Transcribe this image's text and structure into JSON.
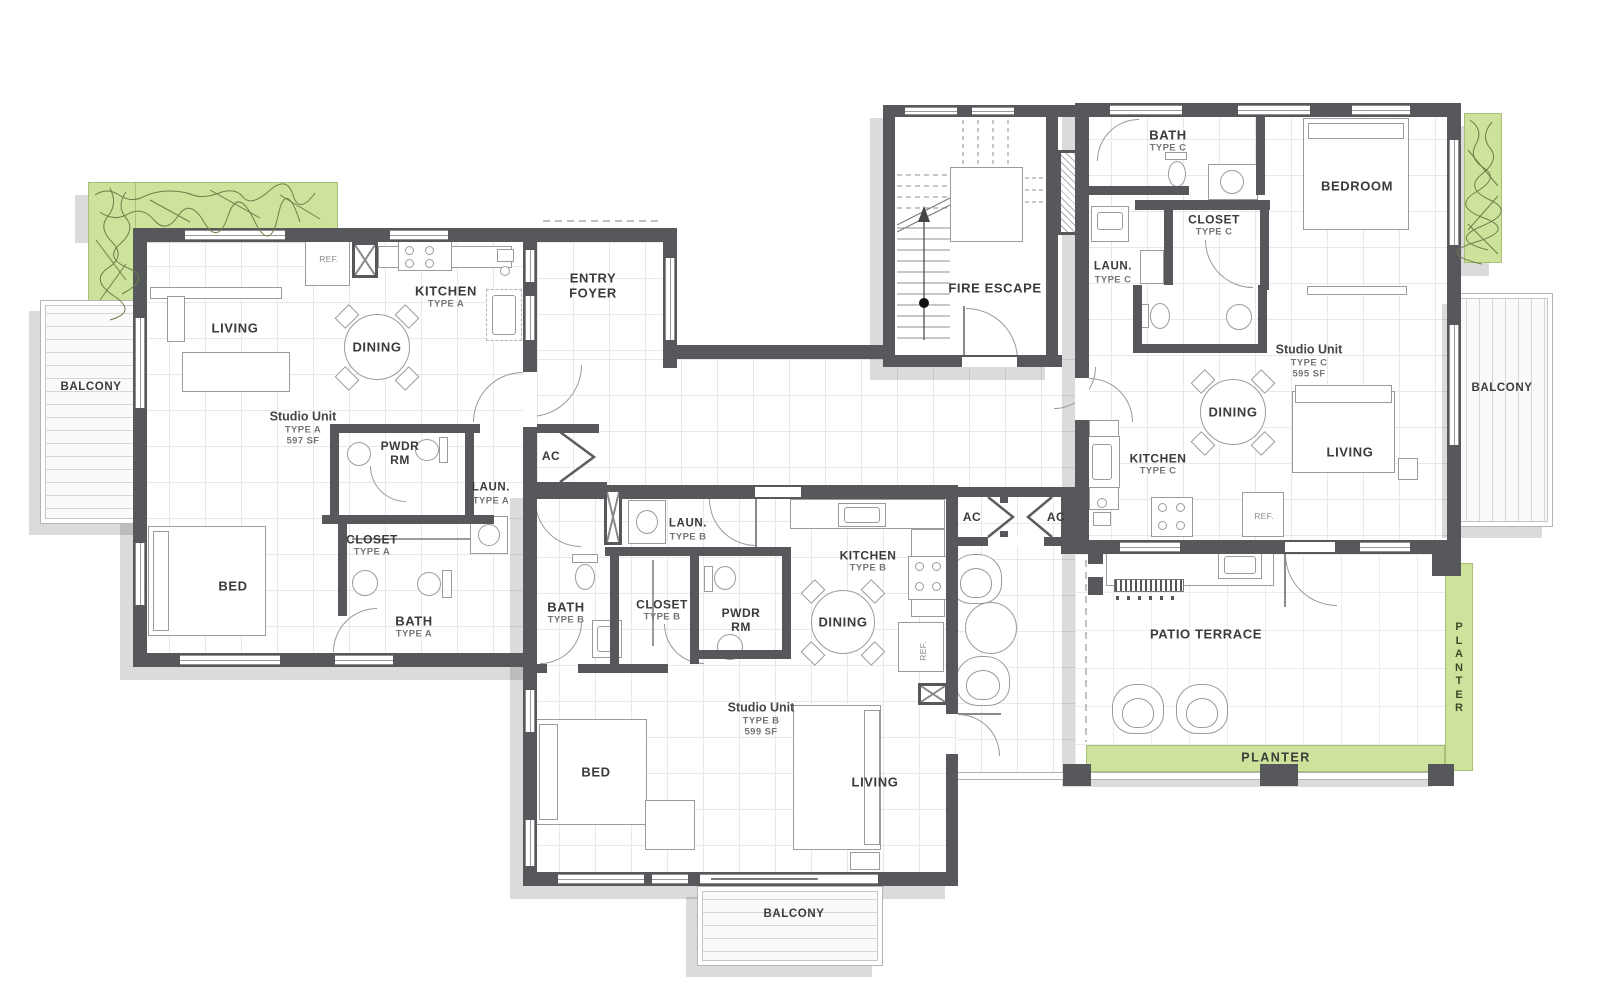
{
  "drawing": {
    "kind": "residential floor plan",
    "units": [
      {
        "name": "Studio Unit",
        "type": "TYPE A",
        "area": "597 SF"
      },
      {
        "name": "Studio Unit",
        "type": "TYPE B",
        "area": "599 SF"
      },
      {
        "name": "Studio Unit",
        "type": "TYPE C",
        "area": "595 SF"
      }
    ]
  },
  "colors": {
    "wall": "#57585c",
    "planter_green": "#cde39c",
    "shadow": "rgba(0,0,0,0.14)",
    "text_main": "#3b3b3b",
    "text_sub": "#747474"
  },
  "labels": [
    {
      "name": "room-label-living-a",
      "x": 235,
      "y": 328,
      "lines": [
        {
          "t": "LIVING",
          "s": "main"
        }
      ]
    },
    {
      "name": "room-label-dining-a",
      "x": 377,
      "y": 347,
      "lines": [
        {
          "t": "DINING",
          "s": "main"
        }
      ]
    },
    {
      "name": "room-label-kitchen-a",
      "x": 446,
      "y": 297,
      "lines": [
        {
          "t": "KITCHEN",
          "s": "main"
        },
        {
          "t": "TYPE A",
          "s": "sub"
        }
      ]
    },
    {
      "name": "label-ref-a",
      "x": 329,
      "y": 259,
      "lines": [
        {
          "t": "REF.",
          "s": "tiny"
        }
      ]
    },
    {
      "name": "unit-label-studio-a",
      "x": 303,
      "y": 428,
      "lines": [
        {
          "t": "Studio Unit",
          "s": "studio"
        },
        {
          "t": "TYPE A",
          "s": "sub"
        },
        {
          "t": "597 SF",
          "s": "sub"
        }
      ]
    },
    {
      "name": "room-label-pwdr-a",
      "x": 400,
      "y": 453,
      "lines": [
        {
          "t": "PWDR",
          "s": "main12"
        },
        {
          "t": "RM",
          "s": "main12"
        }
      ]
    },
    {
      "name": "label-ac-a",
      "x": 551,
      "y": 456,
      "lines": [
        {
          "t": "AC",
          "s": "main12"
        }
      ]
    },
    {
      "name": "room-label-laun-a",
      "x": 491,
      "y": 494,
      "lines": [
        {
          "t": "LAUN.",
          "s": "main11"
        },
        {
          "t": "TYPE A",
          "s": "sub"
        }
      ]
    },
    {
      "name": "room-label-closet-a",
      "x": 372,
      "y": 545,
      "lines": [
        {
          "t": "CLOSET",
          "s": "main12"
        },
        {
          "t": "TYPE A",
          "s": "sub"
        }
      ]
    },
    {
      "name": "room-label-bed-a",
      "x": 233,
      "y": 586,
      "lines": [
        {
          "t": "BED",
          "s": "main"
        }
      ]
    },
    {
      "name": "room-label-bath-a",
      "x": 414,
      "y": 627,
      "lines": [
        {
          "t": "BATH",
          "s": "main"
        },
        {
          "t": "TYPE A",
          "s": "sub"
        }
      ]
    },
    {
      "name": "room-label-entry-foyer",
      "x": 593,
      "y": 286,
      "lines": [
        {
          "t": "ENTRY",
          "s": "main"
        },
        {
          "t": "FOYER",
          "s": "main"
        }
      ]
    },
    {
      "name": "room-label-fire-escape",
      "x": 995,
      "y": 288,
      "lines": [
        {
          "t": "FIRE ESCAPE",
          "s": "main"
        }
      ]
    },
    {
      "name": "label-balcony-left",
      "x": 91,
      "y": 388,
      "lines": [
        {
          "t": "BALCONY",
          "s": "main11"
        }
      ]
    },
    {
      "name": "label-ac-mid-1",
      "x": 972,
      "y": 517,
      "lines": [
        {
          "t": "AC",
          "s": "main12"
        }
      ]
    },
    {
      "name": "label-ac-mid-2",
      "x": 1056,
      "y": 517,
      "lines": [
        {
          "t": "AC",
          "s": "main12"
        }
      ]
    },
    {
      "name": "room-label-bath-c",
      "x": 1168,
      "y": 141,
      "lines": [
        {
          "t": "BATH",
          "s": "main"
        },
        {
          "t": "TYPE C",
          "s": "sub"
        }
      ]
    },
    {
      "name": "room-label-bedroom-c",
      "x": 1357,
      "y": 186,
      "lines": [
        {
          "t": "BEDROOM",
          "s": "main"
        }
      ]
    },
    {
      "name": "room-label-closet-c",
      "x": 1214,
      "y": 225,
      "lines": [
        {
          "t": "CLOSET",
          "s": "main12"
        },
        {
          "t": "TYPE C",
          "s": "sub"
        }
      ]
    },
    {
      "name": "room-label-laun-c",
      "x": 1113,
      "y": 273,
      "lines": [
        {
          "t": "LAUN.",
          "s": "main11"
        },
        {
          "t": "TYPE C",
          "s": "sub"
        }
      ]
    },
    {
      "name": "unit-label-studio-c",
      "x": 1309,
      "y": 361,
      "lines": [
        {
          "t": "Studio Unit",
          "s": "studio"
        },
        {
          "t": "TYPE C",
          "s": "sub"
        },
        {
          "t": "595 SF",
          "s": "sub"
        }
      ]
    },
    {
      "name": "room-label-dining-c",
      "x": 1233,
      "y": 412,
      "lines": [
        {
          "t": "DINING",
          "s": "main"
        }
      ]
    },
    {
      "name": "room-label-kitchen-c",
      "x": 1158,
      "y": 464,
      "lines": [
        {
          "t": "KITCHEN",
          "s": "main12"
        },
        {
          "t": "TYPE C",
          "s": "sub"
        }
      ]
    },
    {
      "name": "room-label-living-c",
      "x": 1350,
      "y": 452,
      "lines": [
        {
          "t": "LIVING",
          "s": "main"
        }
      ]
    },
    {
      "name": "label-ref-c",
      "x": 1264,
      "y": 516,
      "lines": [
        {
          "t": "REF.",
          "s": "tiny"
        }
      ]
    },
    {
      "name": "label-balcony-right",
      "x": 1502,
      "y": 389,
      "lines": [
        {
          "t": "BALCONY",
          "s": "main11"
        }
      ]
    },
    {
      "name": "room-label-laun-b",
      "x": 688,
      "y": 530,
      "lines": [
        {
          "t": "LAUN.",
          "s": "main11"
        },
        {
          "t": "TYPE B",
          "s": "sub"
        }
      ]
    },
    {
      "name": "room-label-bath-b",
      "x": 566,
      "y": 613,
      "lines": [
        {
          "t": "BATH",
          "s": "main"
        },
        {
          "t": "TYPE B",
          "s": "sub"
        }
      ]
    },
    {
      "name": "room-label-closet-b",
      "x": 662,
      "y": 610,
      "lines": [
        {
          "t": "CLOSET",
          "s": "main12"
        },
        {
          "t": "TYPE B",
          "s": "sub"
        }
      ]
    },
    {
      "name": "room-label-pwdr-b",
      "x": 741,
      "y": 620,
      "lines": [
        {
          "t": "PWDR",
          "s": "main12"
        },
        {
          "t": "RM",
          "s": "main12"
        }
      ]
    },
    {
      "name": "room-label-kitchen-b",
      "x": 868,
      "y": 561,
      "lines": [
        {
          "t": "KITCHEN",
          "s": "main12"
        },
        {
          "t": "TYPE B",
          "s": "sub"
        }
      ]
    },
    {
      "name": "room-label-dining-b",
      "x": 843,
      "y": 622,
      "lines": [
        {
          "t": "DINING",
          "s": "main"
        }
      ]
    },
    {
      "name": "label-ref-b",
      "x": 923,
      "y": 651,
      "rot": -90,
      "lines": [
        {
          "t": "REF.",
          "s": "tiny"
        }
      ]
    },
    {
      "name": "unit-label-studio-b",
      "x": 761,
      "y": 719,
      "lines": [
        {
          "t": "Studio Unit",
          "s": "studio"
        },
        {
          "t": "TYPE B",
          "s": "sub"
        },
        {
          "t": "599 SF",
          "s": "sub"
        }
      ]
    },
    {
      "name": "room-label-bed-b",
      "x": 596,
      "y": 772,
      "lines": [
        {
          "t": "BED",
          "s": "main"
        }
      ]
    },
    {
      "name": "room-label-living-b",
      "x": 875,
      "y": 782,
      "lines": [
        {
          "t": "LIVING",
          "s": "main"
        }
      ]
    },
    {
      "name": "label-balcony-bottom",
      "x": 794,
      "y": 915,
      "lines": [
        {
          "t": "BALCONY",
          "s": "main11"
        }
      ]
    },
    {
      "name": "room-label-patio-terrace",
      "x": 1206,
      "y": 634,
      "lines": [
        {
          "t": "PATIO TERRACE",
          "s": "main"
        }
      ]
    },
    {
      "name": "label-planter-bottom",
      "x": 1276,
      "y": 758,
      "lines": [
        {
          "t": "PLANTER",
          "s": "pl"
        }
      ]
    },
    {
      "name": "label-planter-right",
      "x": 1459,
      "y": 668,
      "lines": [
        {
          "t": "P",
          "s": "vl"
        },
        {
          "t": "L",
          "s": "vl"
        },
        {
          "t": "A",
          "s": "vl"
        },
        {
          "t": "N",
          "s": "vl"
        },
        {
          "t": "T",
          "s": "vl"
        },
        {
          "t": "E",
          "s": "vl"
        },
        {
          "t": "R",
          "s": "vl"
        }
      ]
    }
  ]
}
